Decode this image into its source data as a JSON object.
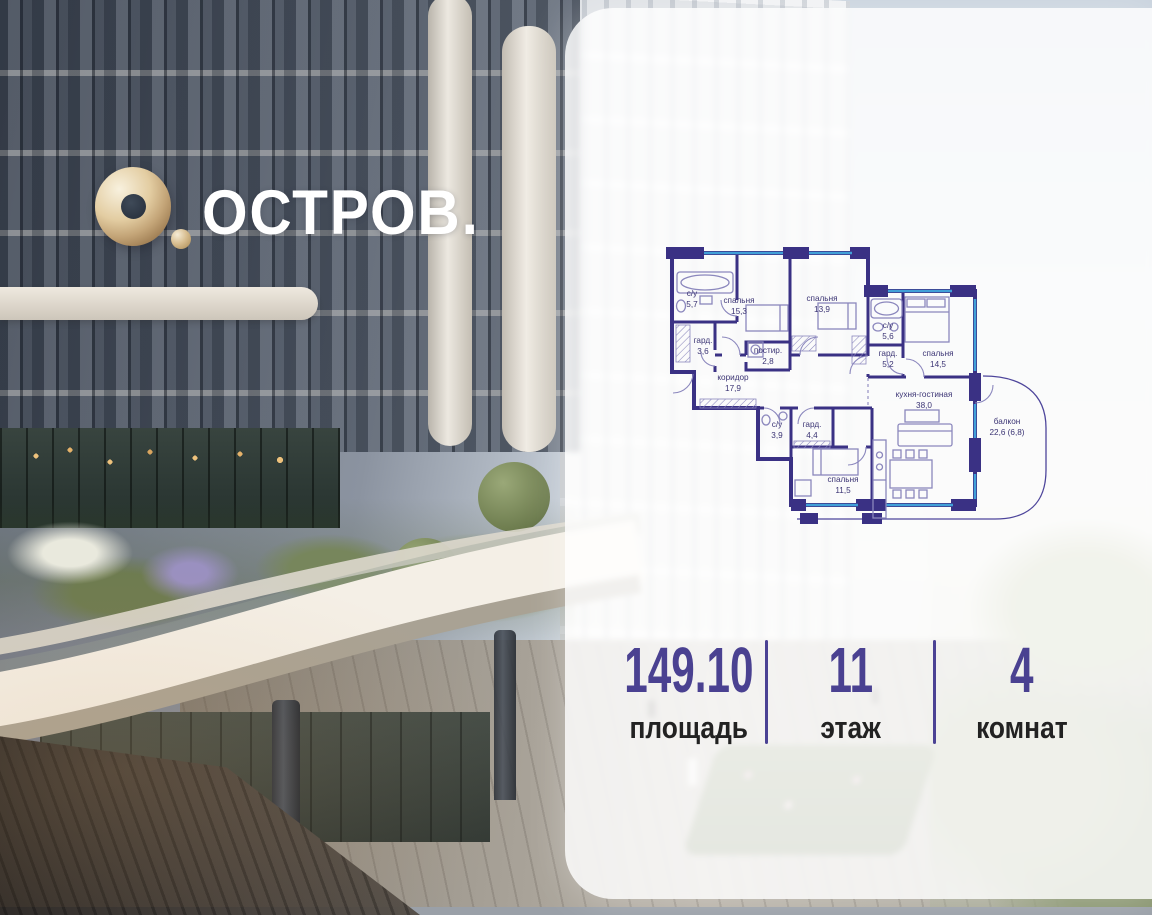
{
  "brand": {
    "wordmark": "ОСТРОВ.",
    "logo_icon": "gold-torus",
    "logo_gold": "#c3a477",
    "text_color": "#ffffff"
  },
  "card": {
    "accent_color": "#4a4191",
    "label_color": "#222222",
    "floorplan": {
      "colors": {
        "walls": "#3a3184",
        "windows": "#41a0d8",
        "furniture": "#8b87bd",
        "labels": "#3b3474"
      },
      "rooms": [
        {
          "name": "с/у",
          "area": "5,7"
        },
        {
          "name": "спальня",
          "area": "15,3"
        },
        {
          "name": "гард.",
          "area": "3,6"
        },
        {
          "name": "постир.",
          "area": "2,8"
        },
        {
          "name": "спальня",
          "area": "13,9"
        },
        {
          "name": "коридор",
          "area": "17,9"
        },
        {
          "name": "с/у",
          "area": "5,6"
        },
        {
          "name": "гард.",
          "area": "5,2"
        },
        {
          "name": "спальня",
          "area": "14,5"
        },
        {
          "name": "кухня-гостиная",
          "area": "38,0"
        },
        {
          "name": "с/у",
          "area": "3,9"
        },
        {
          "name": "гард.",
          "area": "4,4"
        },
        {
          "name": "спальня",
          "area": "11,5"
        },
        {
          "name": "балкон",
          "area": "22,6 (6,8)"
        }
      ]
    },
    "stats": [
      {
        "value": "149.10",
        "label": "площадь"
      },
      {
        "value": "11",
        "label": "этаж"
      },
      {
        "value": "4",
        "label": "комнат"
      }
    ]
  }
}
